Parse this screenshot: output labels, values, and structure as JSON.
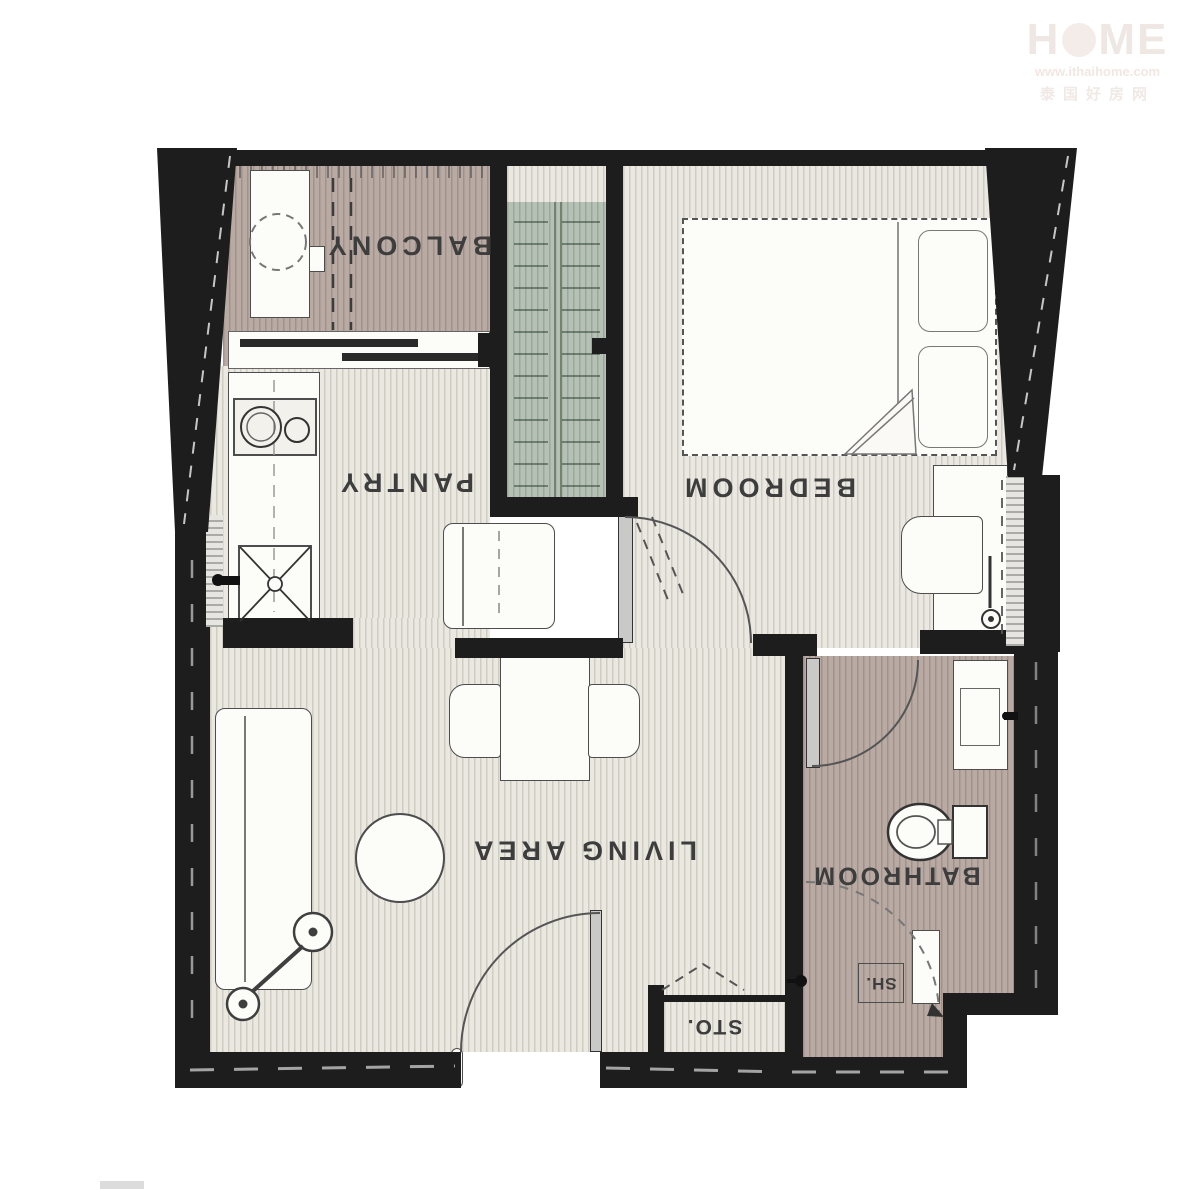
{
  "rooms": {
    "balcony": {
      "label": "BALCONY"
    },
    "pantry": {
      "label": "PANTRY"
    },
    "bedroom": {
      "label": "BEDROOM"
    },
    "living": {
      "label": "LIVING AREA"
    },
    "bathroom": {
      "label": "BATHROOM"
    },
    "storage": {
      "label": "STO."
    },
    "shower": {
      "label": "SH."
    }
  },
  "watermark": {
    "brand_left": "H",
    "brand_right": "ME",
    "url": "www.ithaihome.com",
    "chinese": "泰国好房网"
  },
  "colors": {
    "wall": "#1d1d1d",
    "floor_stripe": "#cfccc2",
    "floor_base": "#eae8e1",
    "balcony_bathroom_floor": "#b9aaa4",
    "wardrobe_fill": "#b6c1b5",
    "label_text": "#3d3d3d",
    "watermark": "#efe7e3"
  }
}
